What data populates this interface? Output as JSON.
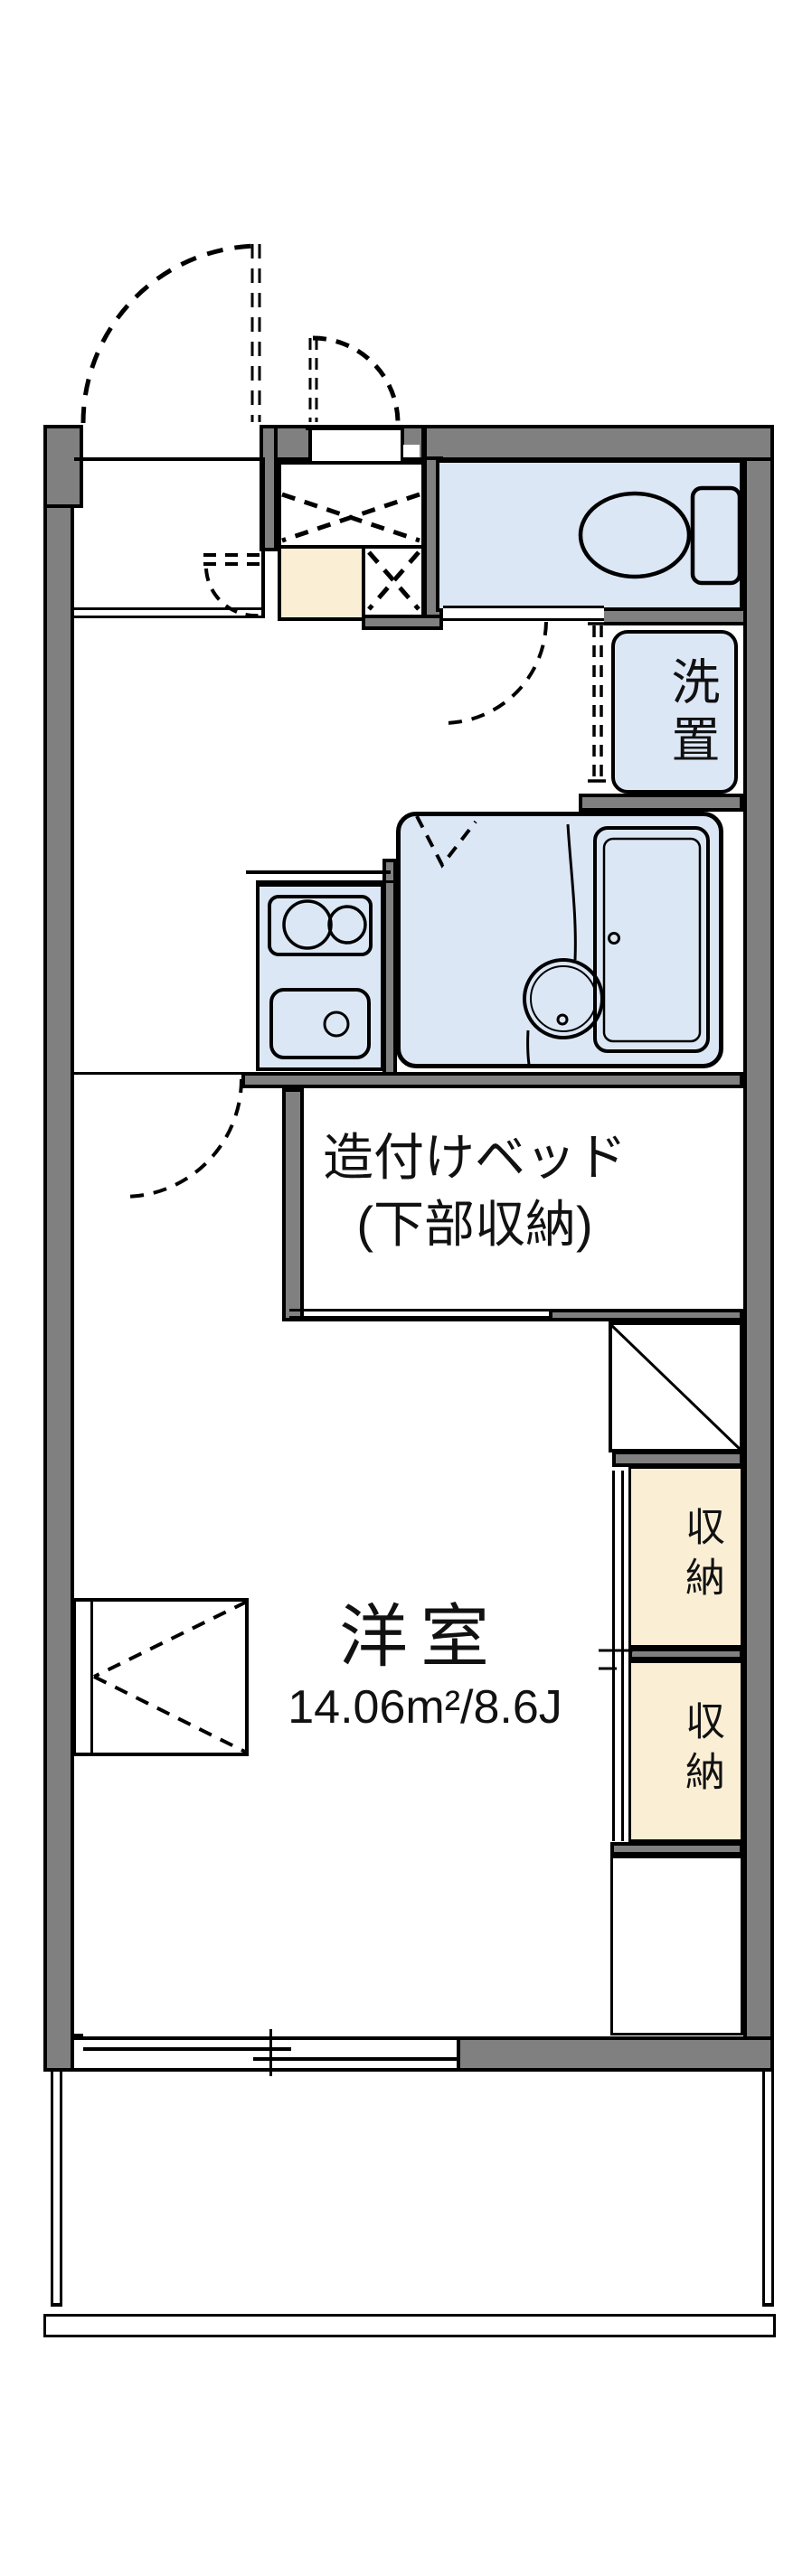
{
  "floorplan": {
    "labels": {
      "bed_line1": "造付けベッド",
      "bed_line2": "(下部収納)",
      "room_name": "洋室",
      "room_size": "14.06m²/8.6J",
      "laundry": "洗置",
      "storage_upper": "収納",
      "storage_lower": "収納"
    },
    "icon_names": [
      "toilet-icon",
      "bathtub-icon",
      "wash-basin-icon",
      "stove-burner-icon",
      "kitchen-sink-icon",
      "door-swing-arc",
      "sliding-window",
      "balcony-railing"
    ],
    "colors": {
      "wall_gray": "#808080",
      "water_blue": "#dce7f6",
      "tile_beige": "#faeed4",
      "line_black": "#000000",
      "background": "#ffffff"
    }
  }
}
